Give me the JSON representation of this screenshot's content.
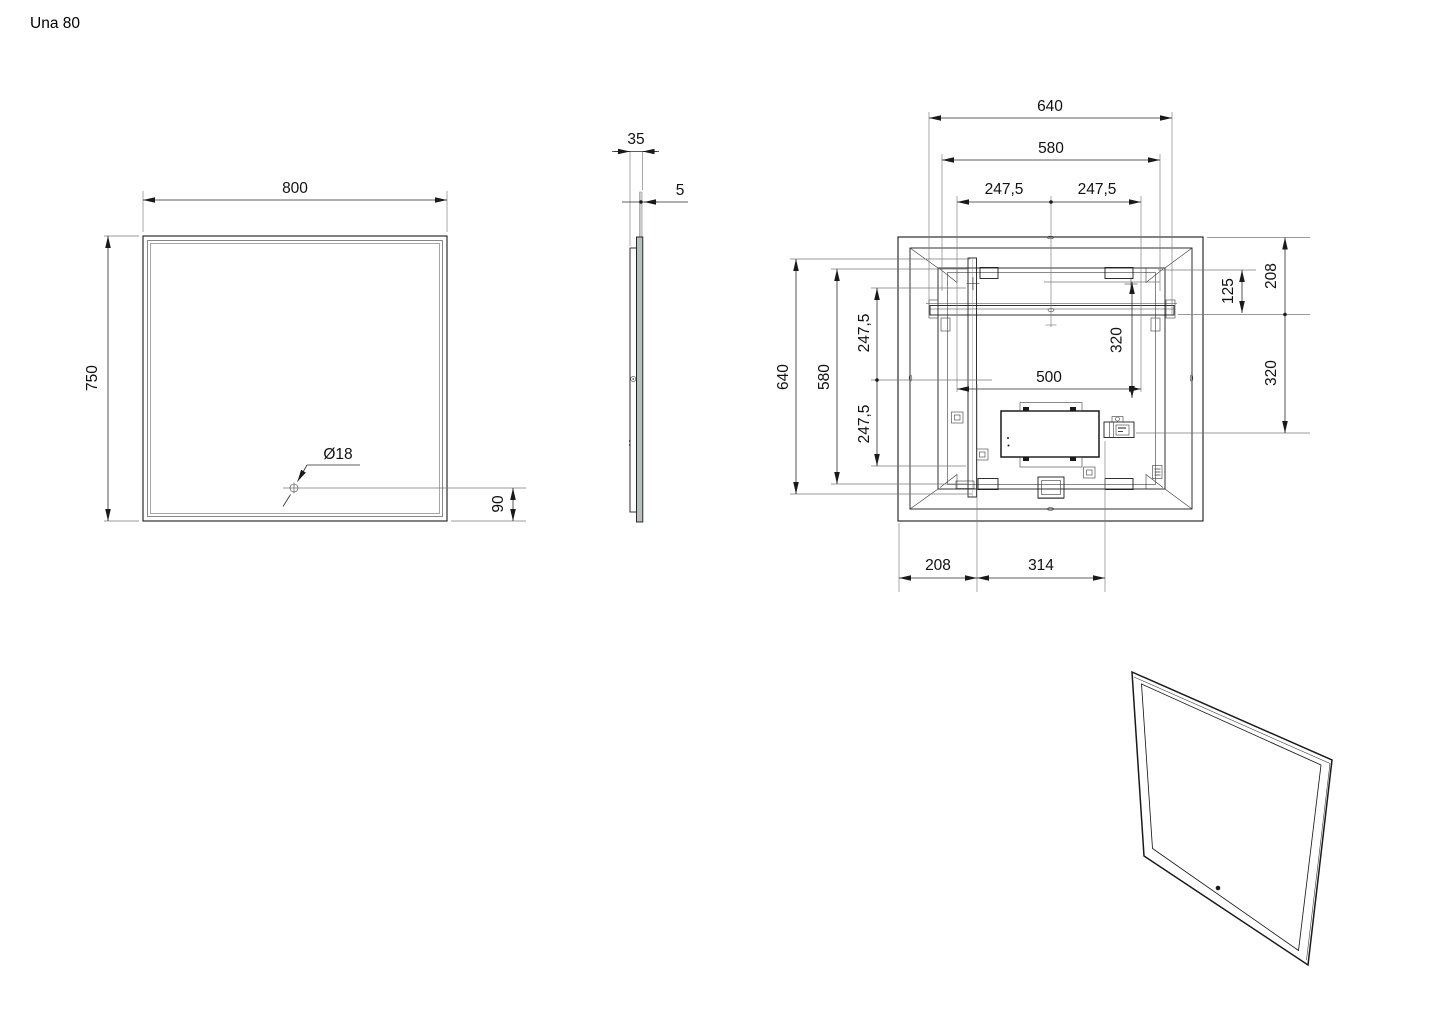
{
  "title": "Una 80",
  "views": {
    "front": {
      "width": "800",
      "height": "750",
      "sensor_diameter": "Ø18",
      "sensor_bottom_offset": "90"
    },
    "side": {
      "total_depth": "35",
      "glass_thickness": "5"
    },
    "back": {
      "top_rail_length": "640",
      "top_span": "580",
      "top_left_half": "247,5",
      "top_right_half": "247,5",
      "left_profile_length": "640",
      "left_span": "580",
      "left_upper_half": "247,5",
      "left_lower_half": "247,5",
      "right_top_to_rail": "208",
      "right_bracket_to_rail": "125",
      "right_rail_to_outlet": "320",
      "inner_rail_drop": "320",
      "inner_width": "500",
      "bottom_left_offset": "208",
      "bottom_span": "314"
    }
  }
}
